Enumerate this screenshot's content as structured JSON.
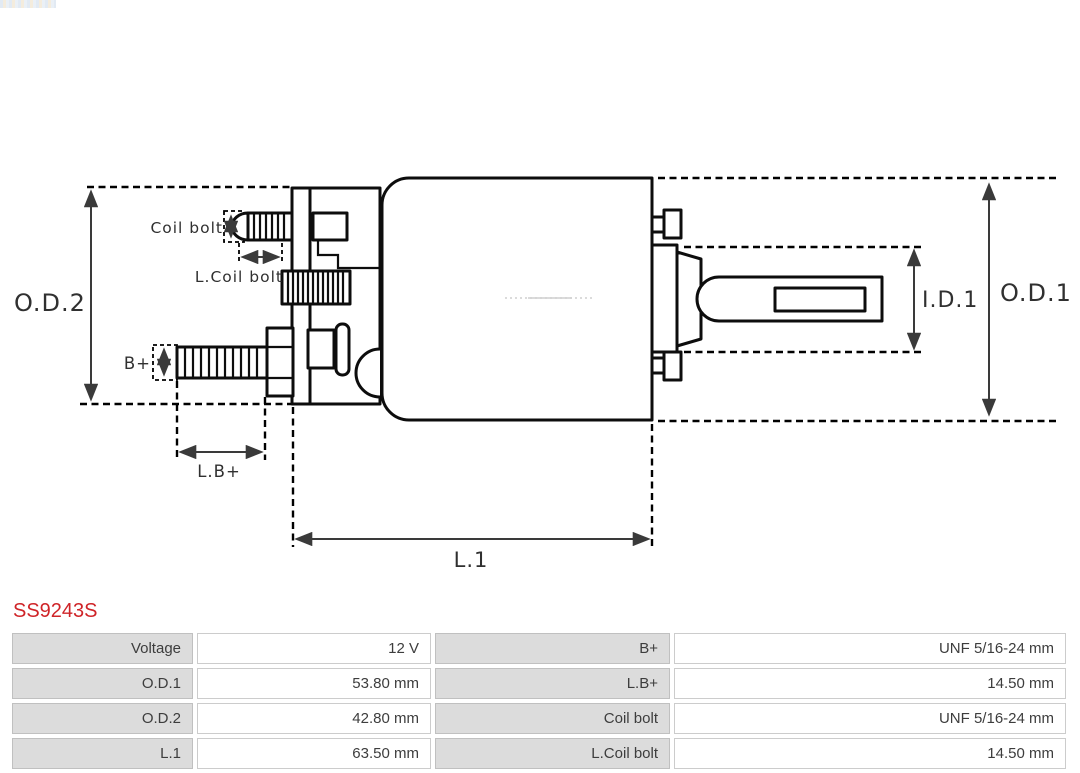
{
  "part_number": "SS9243S",
  "icons": {
    "brand_mark": "as-pl-logo-strip"
  },
  "colors": {
    "part_number_red": "#cf2428",
    "table_label_bg": "#dcdcdc",
    "table_text": "#3d3d3d",
    "drawing_line": "#0d0d0d",
    "dimension_line": "#3a3a3a"
  },
  "diagram": {
    "dimension_labels": {
      "od2": "O.D.2",
      "coil_bolt": "Coil bolt",
      "l_coil_bolt": "L.Coil bolt",
      "b_plus": "B+",
      "l_b_plus": "L.B+",
      "l1": "L.1",
      "id1": "I.D.1",
      "od1": "O.D.1"
    }
  },
  "spec_table": {
    "rows": [
      [
        "Voltage",
        "12 V",
        "B+",
        "UNF 5/16-24 mm"
      ],
      [
        "O.D.1",
        "53.80 mm",
        "L.B+",
        "14.50 mm"
      ],
      [
        "O.D.2",
        "42.80 mm",
        "Coil bolt",
        "UNF 5/16-24 mm"
      ],
      [
        "L.1",
        "63.50 mm",
        "L.Coil bolt",
        "14.50 mm"
      ]
    ]
  }
}
